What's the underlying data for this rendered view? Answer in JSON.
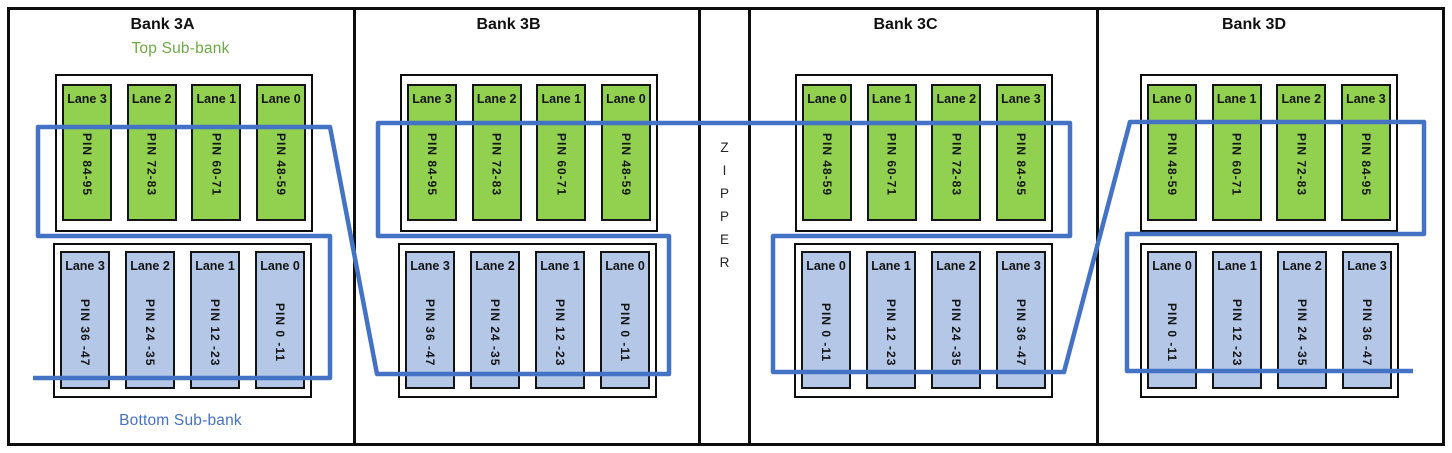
{
  "banks": [
    {
      "id": "3A",
      "title": "Bank 3A",
      "top_sublabel": "Top Sub-bank",
      "bottom_sublabel": "Bottom Sub-bank",
      "top_lanes": [
        {
          "label": "Lane 3",
          "pin": "PIN 84-95"
        },
        {
          "label": "Lane 2",
          "pin": "PIN 72-83"
        },
        {
          "label": "Lane 1",
          "pin": "PIN 60-71"
        },
        {
          "label": "Lane 0",
          "pin": "PIN 48-59"
        }
      ],
      "bottom_lanes": [
        {
          "label": "Lane 3",
          "pin": "PIN 36 -47"
        },
        {
          "label": "Lane 2",
          "pin": "PIN 24 -35"
        },
        {
          "label": "Lane 1",
          "pin": "PIN 12 -23"
        },
        {
          "label": "Lane 0",
          "pin": "PIN 0 -11"
        }
      ]
    },
    {
      "id": "3B",
      "title": "Bank 3B",
      "top_lanes": [
        {
          "label": "Lane 3",
          "pin": "PIN 84-95"
        },
        {
          "label": "Lane 2",
          "pin": "PIN 72-83"
        },
        {
          "label": "Lane 1",
          "pin": "PIN 60-71"
        },
        {
          "label": "Lane 0",
          "pin": "PIN 48-59"
        }
      ],
      "bottom_lanes": [
        {
          "label": "Lane 3",
          "pin": "PIN 36 -47"
        },
        {
          "label": "Lane 2",
          "pin": "PIN 24 -35"
        },
        {
          "label": "Lane 1",
          "pin": "PIN 12 -23"
        },
        {
          "label": "Lane 0",
          "pin": "PIN 0 -11"
        }
      ]
    },
    {
      "id": "3C",
      "title": "Bank 3C",
      "top_lanes": [
        {
          "label": "Lane 0",
          "pin": "PIN 48-59"
        },
        {
          "label": "Lane 1",
          "pin": "PIN 60-71"
        },
        {
          "label": "Lane 2",
          "pin": "PIN 72-83"
        },
        {
          "label": "Lane 3",
          "pin": "PIN 84-95"
        }
      ],
      "bottom_lanes": [
        {
          "label": "Lane 0",
          "pin": "PIN 0 -11"
        },
        {
          "label": "Lane 1",
          "pin": "PIN 12 -23"
        },
        {
          "label": "Lane 2",
          "pin": "PIN 24 -35"
        },
        {
          "label": "Lane 3",
          "pin": "PIN 36 -47"
        }
      ]
    },
    {
      "id": "3D",
      "title": "Bank 3D",
      "top_lanes": [
        {
          "label": "Lane 0",
          "pin": "PIN 48-59"
        },
        {
          "label": "Lane 1",
          "pin": "PIN 60-71"
        },
        {
          "label": "Lane 2",
          "pin": "PIN 72-83"
        },
        {
          "label": "Lane 3",
          "pin": "PIN 84-95"
        }
      ],
      "bottom_lanes": [
        {
          "label": "Lane 0",
          "pin": "PIN 0 -11"
        },
        {
          "label": "Lane 1",
          "pin": "PIN 12 -23"
        },
        {
          "label": "Lane 2",
          "pin": "PIN 24 -35"
        },
        {
          "label": "Lane 3",
          "pin": "PIN 36 -47"
        }
      ]
    }
  ],
  "zipper_label": {
    "letters": [
      "Z",
      "I",
      "P",
      "P",
      "E",
      "R"
    ]
  },
  "zipper_path": {
    "color": "#4472c4",
    "stroke_width": 4.5,
    "points": [
      [
        33,
        378
      ],
      [
        330,
        378
      ],
      [
        330,
        236
      ],
      [
        38,
        236
      ],
      [
        38,
        127
      ],
      [
        330,
        127
      ],
      [
        377,
        374
      ],
      [
        669,
        374
      ],
      [
        669,
        236
      ],
      [
        378,
        236
      ],
      [
        378,
        123
      ],
      [
        1070,
        123
      ],
      [
        1070,
        236
      ],
      [
        773,
        236
      ],
      [
        773,
        372
      ],
      [
        1064,
        372
      ],
      [
        1130,
        122
      ],
      [
        1424,
        122
      ],
      [
        1424,
        234
      ],
      [
        1127,
        234
      ],
      [
        1127,
        371
      ],
      [
        1413,
        371
      ]
    ]
  },
  "colors": {
    "top_lane_fill": "#92d050",
    "bottom_lane_fill": "#b4c7e7",
    "top_label_text": "#6faa46",
    "bottom_label_text": "#4472c4",
    "border": "#0d0d0d"
  }
}
